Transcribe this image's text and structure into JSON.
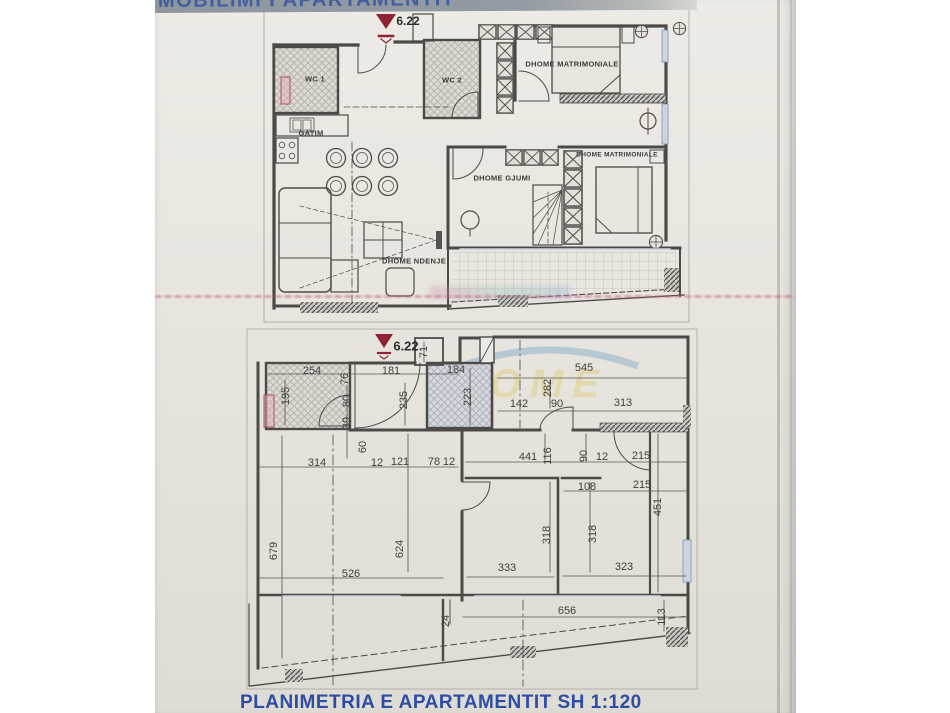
{
  "header": {
    "title": "MOBILIMI I APARTAMENTIT"
  },
  "footer": {
    "title": "PLANIMETRIA E APARTAMENTIT SH 1:120"
  },
  "watermark": {
    "text": "HOME"
  },
  "plan1": {
    "name": "furnished-apartment-plan",
    "level_marker": "6.22",
    "rooms": [
      "WC 1",
      "WC 2",
      "GATIM",
      "DHOME MATRIMONIALE",
      "DHOME GJUMI",
      "DHOME MATRIMONIALE",
      "DHOME NDENJE"
    ]
  },
  "plan2": {
    "name": "dimensioned-apartment-plan",
    "level_marker": "6.22",
    "scale": "1:120",
    "dims": [
      "71",
      "254",
      "76",
      "195",
      "181",
      "184",
      "545",
      "235",
      "223",
      "282",
      "142",
      "90",
      "313",
      "80",
      "39",
      "60",
      "314",
      "12",
      "121",
      "78",
      "12",
      "441",
      "116",
      "90",
      "12",
      "215",
      "108",
      "215",
      "451",
      "679",
      "624",
      "318",
      "318",
      "526",
      "333",
      "323",
      "656",
      "113",
      "24"
    ]
  },
  "colors": {
    "marker_red": "#8e2433",
    "title_blue": "#2d4da5",
    "scan_line_pink": "#c76a8a",
    "paper": "#e6e4dd"
  }
}
